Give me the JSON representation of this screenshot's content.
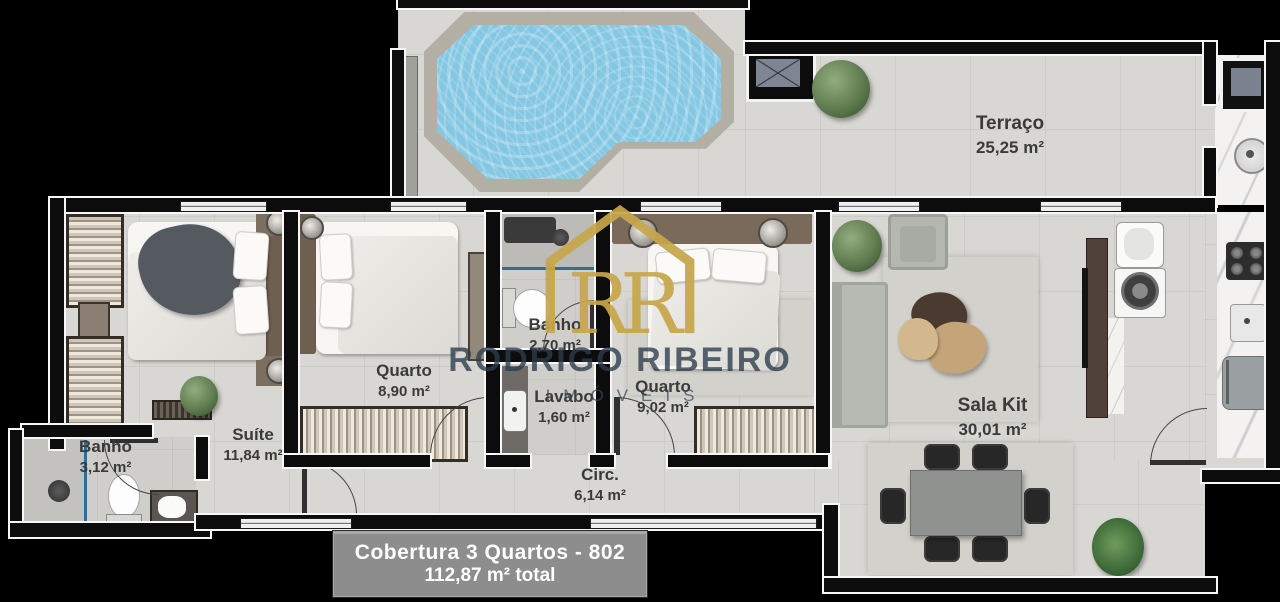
{
  "watermark": {
    "monogram": "RR",
    "brand": "RODRIGO RIBEIRO",
    "brand_sub": "IMÓVEIS"
  },
  "title": {
    "line1": "Cobertura 3 Quartos - 802",
    "line2": "112,87 m² total"
  },
  "rooms": [
    {
      "name": "Terraço",
      "area": "25,25 m²"
    },
    {
      "name": "Suíte",
      "area": "11,84 m²"
    },
    {
      "name": "Quarto",
      "area": "8,90 m²"
    },
    {
      "name": "Banho",
      "area": "2,70 m²"
    },
    {
      "name": "Lavabo",
      "area": "1,60 m²"
    },
    {
      "name": "Quarto",
      "area": "9,02 m²"
    },
    {
      "name": "Banho",
      "area": "3,12 m²"
    },
    {
      "name": "Circ.",
      "area": "6,14 m²"
    },
    {
      "name": "Sala Kit",
      "area": "30,01 m²"
    }
  ],
  "colors": {
    "gold": "#c7a64b",
    "pool_water": "#84c7e2",
    "floor": "#d8d7d3",
    "label_box": "#8d8d8d",
    "wall": "#0c0c0c"
  }
}
